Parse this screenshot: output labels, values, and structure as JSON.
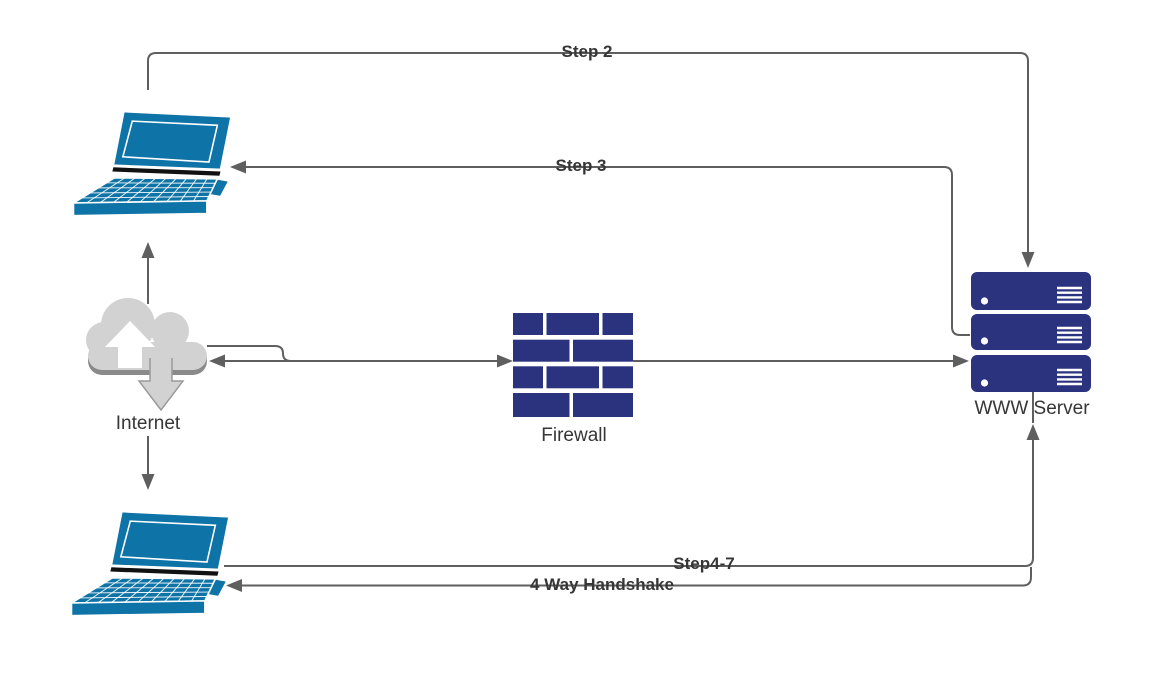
{
  "canvas": {
    "width": 1163,
    "height": 695,
    "background": "#ffffff"
  },
  "nodes": [
    {
      "id": "laptop-top",
      "type": "laptop",
      "icon": "laptop-icon",
      "label": ""
    },
    {
      "id": "internet",
      "type": "cloud",
      "icon": "cloud-upload-download-icon",
      "label": "Internet"
    },
    {
      "id": "firewall",
      "type": "brick-wall",
      "icon": "brick-wall-icon",
      "label": "Firewall"
    },
    {
      "id": "www-server",
      "type": "server-stack",
      "icon": "server-stack-icon",
      "label": "WWW Server"
    },
    {
      "id": "laptop-bottom",
      "type": "laptop",
      "icon": "laptop-icon",
      "label": ""
    }
  ],
  "edges": [
    {
      "label": "Step 2",
      "from": "laptop-top",
      "to": "www-server",
      "arrow": "to"
    },
    {
      "label": "Step 3",
      "from": "www-server",
      "to": "laptop-top",
      "arrow": "to"
    },
    {
      "label": "",
      "from": "internet",
      "to": "laptop-top",
      "arrow": "to"
    },
    {
      "label": "",
      "from": "internet",
      "to": "laptop-bottom",
      "arrow": "to"
    },
    {
      "label": "",
      "from": "internet",
      "to": "firewall",
      "arrow": "both"
    },
    {
      "label": "",
      "from": "firewall",
      "to": "www-server",
      "arrow": "to"
    },
    {
      "label": "Step4-7",
      "from": "laptop-bottom",
      "to": "www-server",
      "arrow": "to"
    },
    {
      "label": "4 Way Handshake",
      "from": "www-server",
      "to": "laptop-bottom",
      "arrow": "to"
    }
  ],
  "colors": {
    "laptop_blue": "#0e73a6",
    "node_navy": "#2c337e",
    "cloud_gray": "#d2d2d2",
    "cloud_rim": "#8a8a8a",
    "connector_gray": "#5f5f5f",
    "label_text": "#363636"
  }
}
